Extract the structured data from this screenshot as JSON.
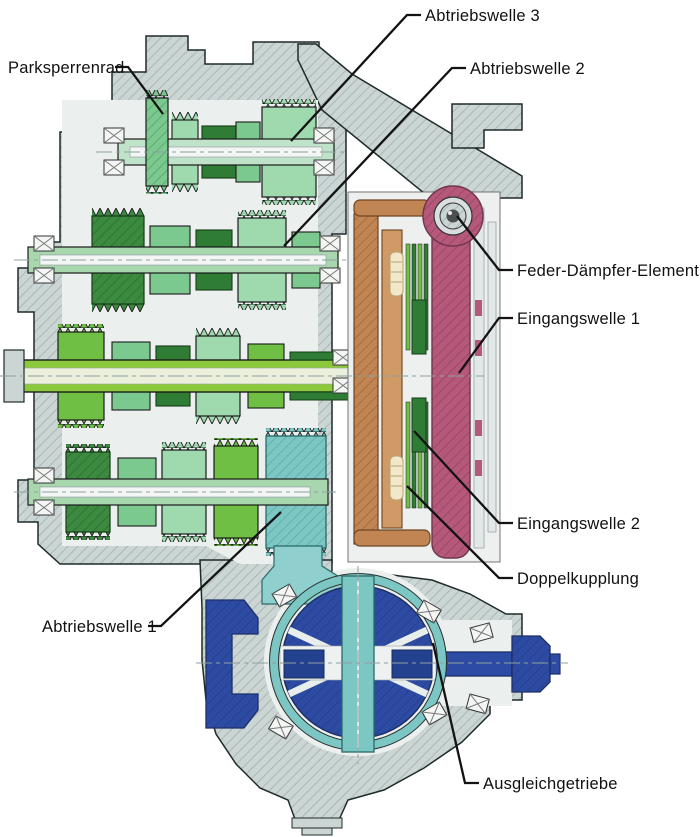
{
  "labels": [
    {
      "id": "parksperrenrad",
      "text": "Parksperrenrad"
    },
    {
      "id": "abtriebswelle3",
      "text": "Abtriebswelle 3"
    },
    {
      "id": "abtriebswelle2",
      "text": "Abtriebswelle 2"
    },
    {
      "id": "feder_daempfer",
      "text": "Feder-Dämpfer-Element"
    },
    {
      "id": "eingangswelle1",
      "text": "Eingangswelle 1"
    },
    {
      "id": "eingangswelle2",
      "text": "Eingangswelle 2"
    },
    {
      "id": "doppelkupplung",
      "text": "Doppelkupplung"
    },
    {
      "id": "abtriebswelle1",
      "text": "Abtriebswelle 1"
    },
    {
      "id": "ausgleichgetriebe",
      "text": "Ausgleichgetriebe"
    }
  ],
  "colors": {
    "background": "#ffffff",
    "housing_gray": "#cbd5d4",
    "gear_mint": "#9fd9ae",
    "gear_green": "#7cc98f",
    "gear_leaf_green": "#6fbf44",
    "gear_dark_green": "#2f7d35",
    "input_shaft_green": "#8cc83c",
    "clutch_drum_pink": "#b5587a",
    "clutch_brown": "#c08552",
    "spring_ivory": "#f2e8c9",
    "differential_blue": "#2e4ba3",
    "differential_teal": "#7cc6c4",
    "leader_line": "#131313"
  }
}
